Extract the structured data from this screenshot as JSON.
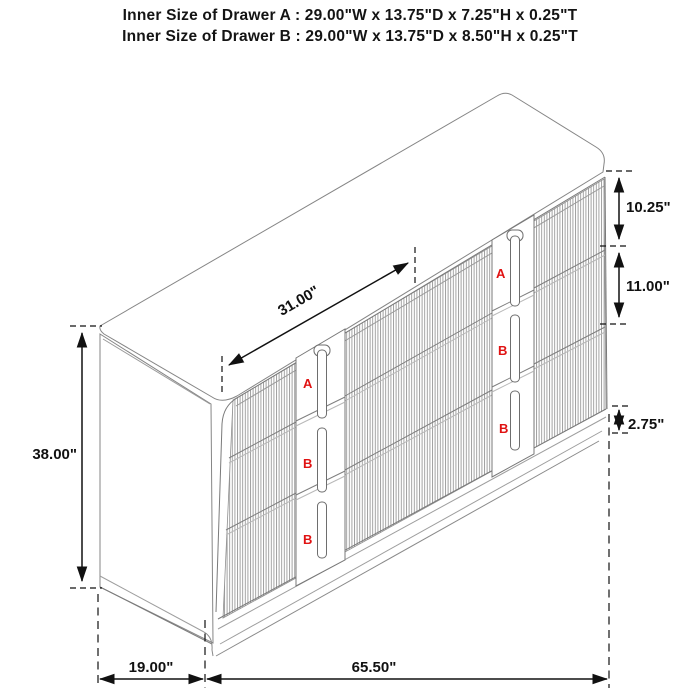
{
  "header": {
    "line1": "Inner Size of Drawer A : 29.00\"W x 13.75\"D x 7.25\"H x 0.25\"T",
    "line2": "Inner Size of Drawer B : 29.00\"W x 13.75\"D x 8.50\"H x 0.25\"T"
  },
  "dimensions": {
    "top_width": "31.00\"",
    "height": "38.00\"",
    "drawer_a_front": "10.25\"",
    "drawer_b_front": "11.00\"",
    "base": "2.75\"",
    "depth": "19.00\"",
    "width": "65.50\""
  },
  "drawer_markers": {
    "a": "A",
    "b": "B"
  },
  "colors": {
    "dimension": "#111111",
    "cabinet_line": "#8a8a8a",
    "marker_red": "#e01212"
  }
}
